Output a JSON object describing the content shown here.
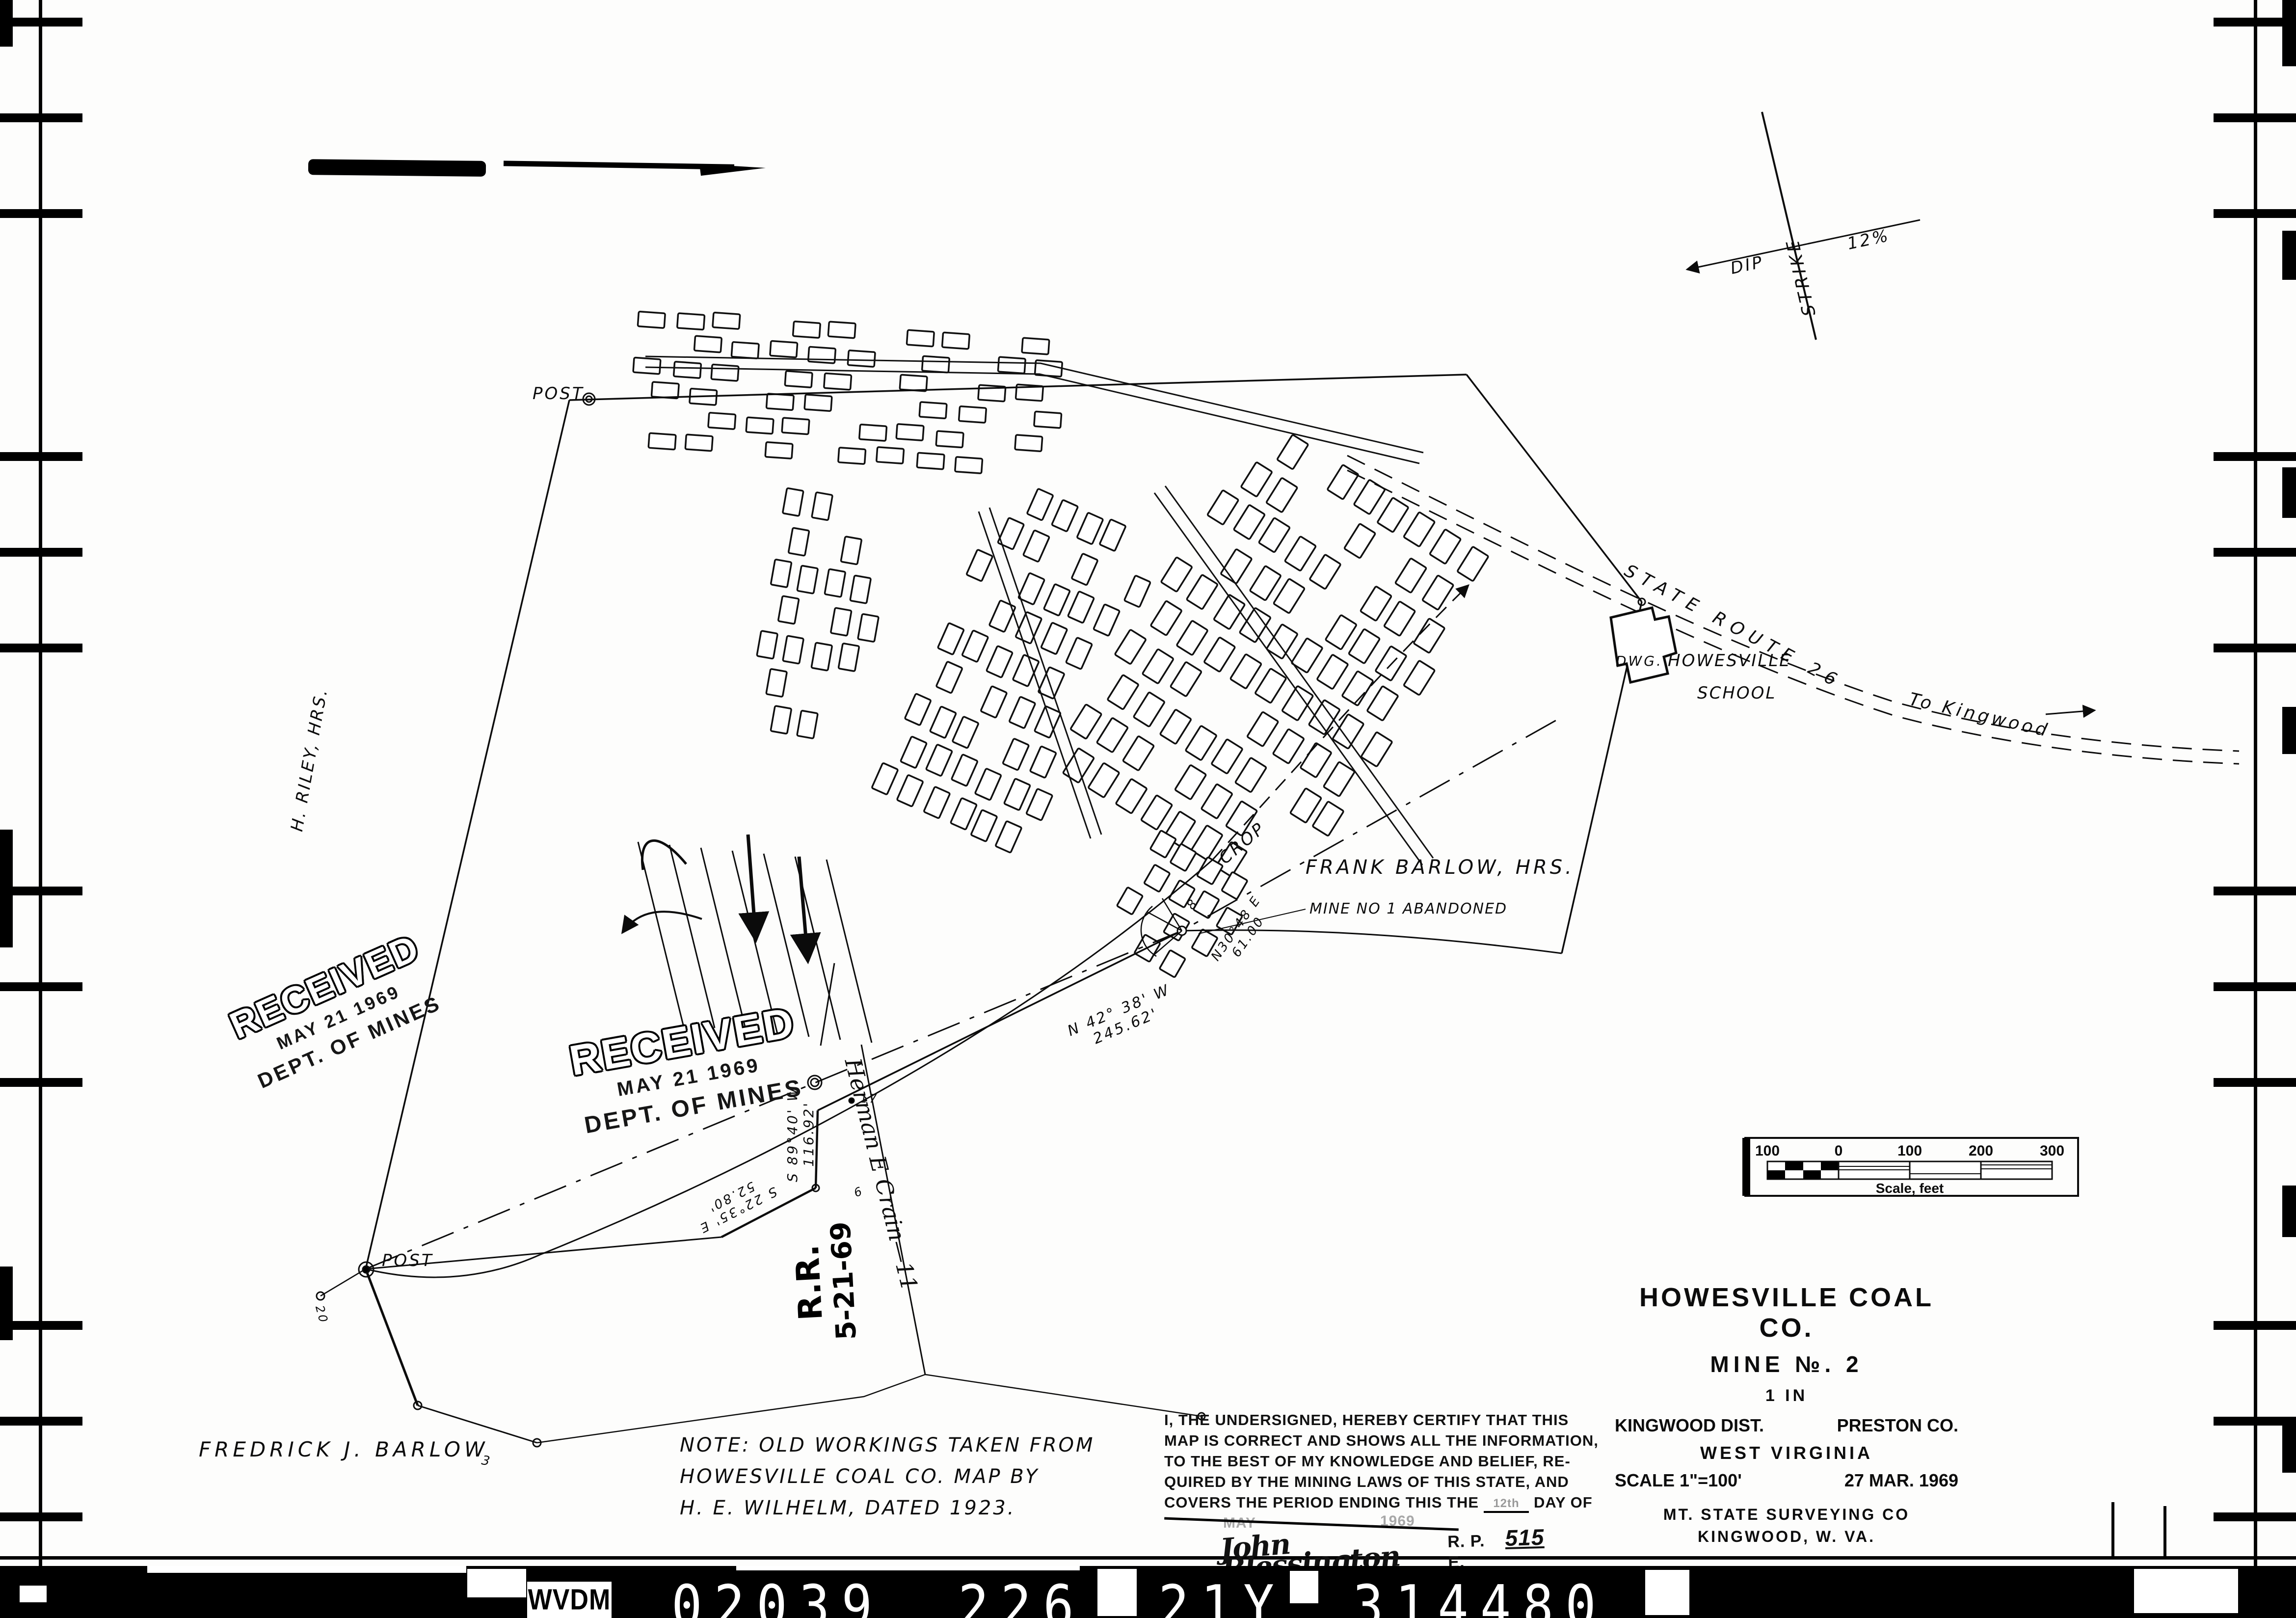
{
  "strip": {
    "wvdm": "WVDM",
    "code1": "02039",
    "code2": "226",
    "code3": "21Y",
    "code4": "314480"
  },
  "title_block": {
    "company": "HOWESVILLE COAL CO.",
    "mine_no": "MINE №. 2",
    "sheet": "1 IN",
    "district": "KINGWOOD DIST.",
    "county": "PRESTON CO.",
    "state": "WEST VIRGINIA",
    "scale": "SCALE 1\"=100'",
    "date": "27 MAR. 1969",
    "surveyor": "MT. STATE SURVEYING CO",
    "surveyor_city": "KINGWOOD, W. VA."
  },
  "scale_bar": {
    "ticks": [
      "100",
      "0",
      "100",
      "200",
      "300"
    ],
    "caption": "Scale, feet"
  },
  "certification": {
    "line1": "I, THE UNDERSIGNED, HEREBY CERTIFY THAT THIS",
    "line2": "MAP IS CORRECT AND SHOWS ALL THE INFORMATION,",
    "line3": "TO THE BEST OF MY KNOWLEDGE AND BELIEF, RE-",
    "line4": "QUIRED BY THE MINING LAWS OF THIS STATE, AND",
    "line5a": "COVERS THE PERIOD ENDING THIS THE",
    "line5b": "DAY OF",
    "day_faint": "12th",
    "month_faint": "MAY",
    "year_faint": "1969",
    "signature": "John Blessington",
    "credential": "R. P. E.",
    "license_no": "515"
  },
  "stamp": {
    "received": "RECEIVED",
    "date": "MAY 21 1969",
    "dept": "DEPT. OF MINES"
  },
  "note": {
    "line1": "NOTE:  OLD WORKINGS TAKEN FROM",
    "line2": "HOWESVILLE  COAL CO.  MAP  BY",
    "line3": "H. E. WILHELM,  DATED  1923."
  },
  "map_labels": {
    "post": "POST",
    "riley": "H. RILEY,  HRS.",
    "fredrick": "FREDRICK  J.  BARLOW",
    "frank": "FRANK  BARLOW,  HRS.",
    "mine1": "MINE NO 1 ABANDONED",
    "crop": "CROP",
    "school_line1": "HOWESVILLE",
    "school_line2": "SCHOOL",
    "dwg": "DWG.",
    "route": "STATE  ROUTE  26",
    "kingwood": "To Kingwood",
    "strike": "STRIKE",
    "dip": "DIP",
    "dip_grade": "12%",
    "b1a": "N 42° 38' W",
    "b1b": "245.62'",
    "b2a": "N30°48 E",
    "b2b": "61.00",
    "b3a": "S 89°40' W",
    "b3b": "116.92'",
    "b4a": "S 22°35' E",
    "b4b": "52.80'",
    "herman": "Herman E Crain—11",
    "rr": "R.R.",
    "rr_date": "5-21-69",
    "t17": "17",
    "t6": "6",
    "t20": "20",
    "t3": "3",
    "t8": "8"
  }
}
